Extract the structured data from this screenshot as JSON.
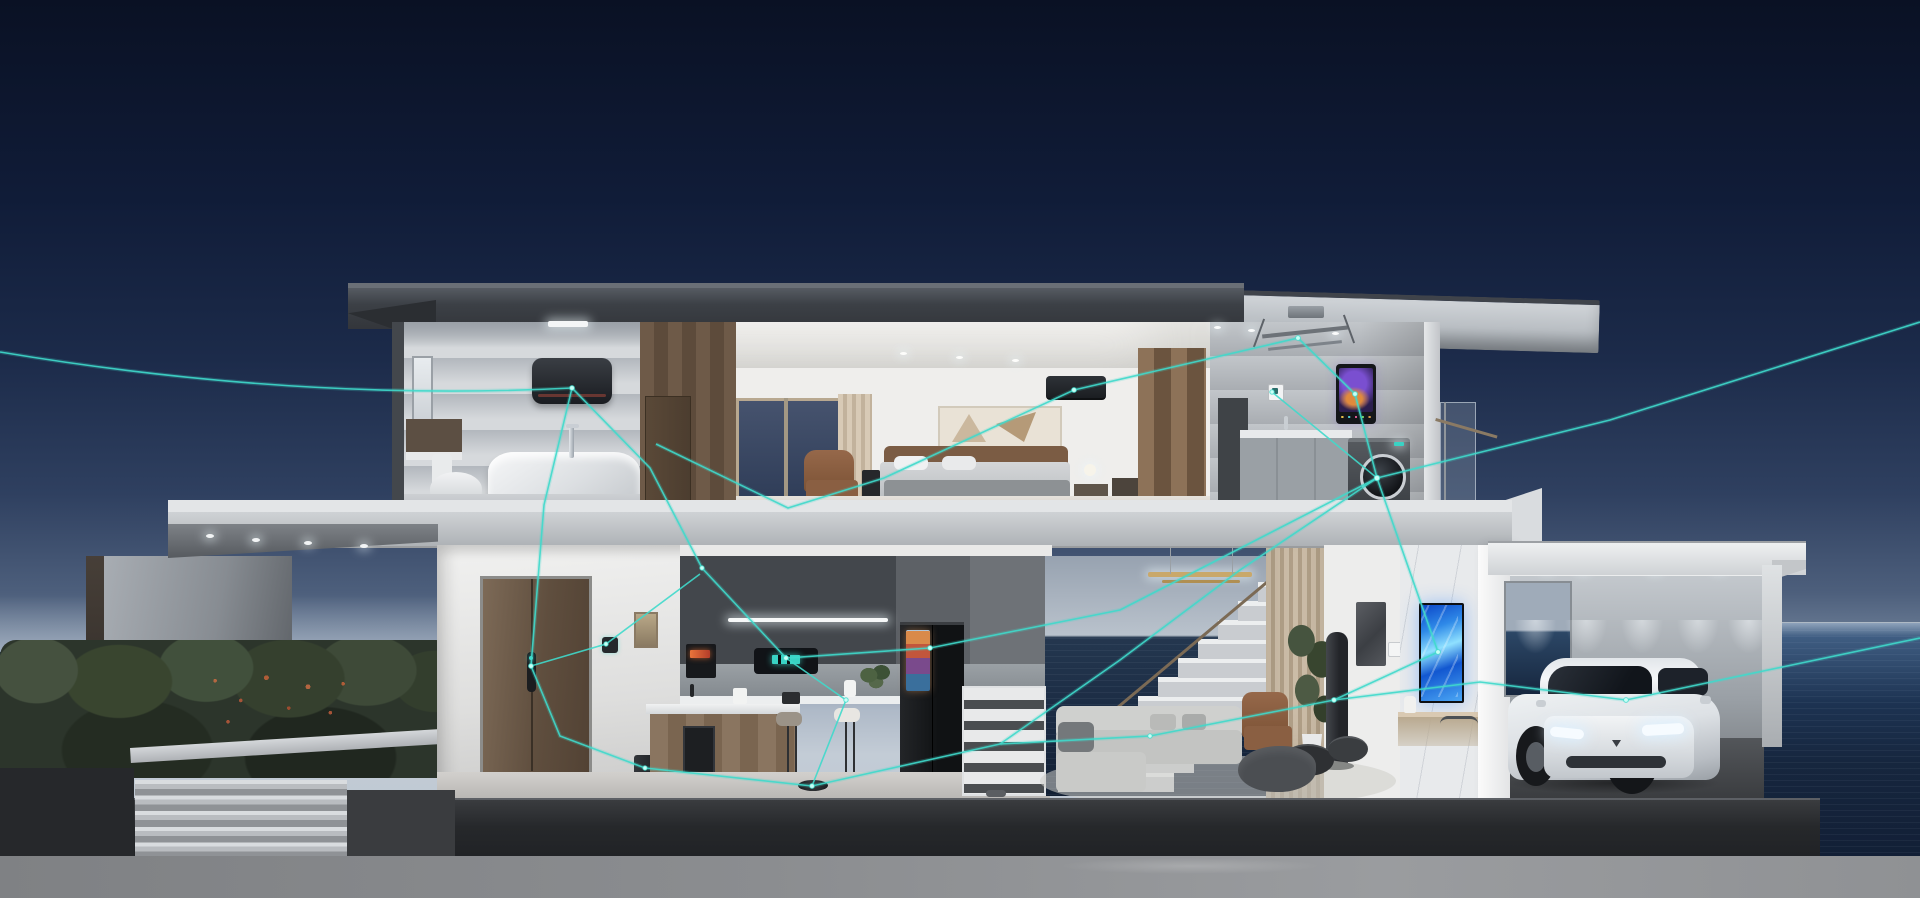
{
  "scene": {
    "title": "smart-home cutaway render",
    "description": "Dusk 3D cutaway of a two-story seaside smart home; glowing teal network lines interconnect IoT appliances in every room; a white electric SUV with lit headlights is parked in the garage",
    "time_of_day": "dusk",
    "setting": "oceanfront"
  },
  "palette": {
    "sky_top": "#0a1124",
    "sky_mid": "#2f4060",
    "horizon_haze": "#c3ccd6",
    "sea_light": "#3f5d82",
    "sea_dark": "#121f36",
    "roof_dark": "#3c4046",
    "concrete_slab": "#cfd2d5",
    "plinth": "#26282b",
    "ground": "#8b8d90",
    "hedge_green": "#323b30",
    "hedge_flower": "#b4583a",
    "door_wood": "#6a5645",
    "network_line": "#3fd9cb",
    "network_node": "#c8fff6",
    "tv_blue": "#2f8ae8",
    "car_white": "#eef1f3",
    "headlight_glow": "#f6fbff"
  },
  "exterior": {
    "ocean": "ocean with wave texture",
    "fence_wall": "concrete boundary wall",
    "hedge": "dense hedge with red-orange blossoms",
    "steps": "wide entry steps",
    "canopy_lights": "recessed canopy downlights",
    "plinth": "dark base plinth",
    "ground": "paved forecourt"
  },
  "rooms": {
    "bathroom": {
      "label": "upstairs bathroom",
      "devices": {
        "ceiling_light": "recessed ceiling light",
        "water_heater": "wall-mounted smart water heater",
        "bathtub": "freestanding bathtub",
        "faucet": "floor-standing tub faucet",
        "toilet": "toilet",
        "mirror_cabinet": "wall mirror cabinet",
        "window": "frosted window"
      }
    },
    "bedroom": {
      "label": "master bedroom",
      "devices": {
        "air_conditioner": "wall-mounted smart air conditioner",
        "artwork": "abstract framed artwork",
        "bed": "double bed",
        "armchair": "leather armchair",
        "media_panel": "bedside media panel",
        "bedside_lamp": "glowing bedside lamp",
        "window": "picture window",
        "curtain": "drape curtain",
        "wardrobe": "wood wardrobe"
      }
    },
    "laundry": {
      "label": "laundry balcony room",
      "devices": {
        "drying_rack": "ceiling-lift smart drying rack",
        "control_screen": "wall control screen with cosmic wallpaper",
        "wall_switch": "smart wall switch",
        "washer": "front-load smart washing machine",
        "cabinets": "laundry cabinets with sink",
        "railing": "glass balcony railing"
      }
    },
    "entry": {
      "label": "entry hall",
      "devices": {
        "front_door": "tall wooden front door",
        "smart_lock": "smart door lock",
        "wall_switch": "smart wall switch",
        "framed_art": "slim framed print",
        "trash_bin": "smart trash bin",
        "doormat": "door mat"
      }
    },
    "kitchen": {
      "label": "open kitchen",
      "devices": {
        "oven": "built-in oven with amber display",
        "hood_display": "built-in hood appliance with teal display",
        "cabinet_light": "under-cabinet light strip",
        "fridge": "smart refrigerator with door screen",
        "island": "kitchen island with appliances",
        "coffee_maker": "white coffee maker",
        "stools": "two bar stools",
        "robot_vacuum": "robot vacuum on floor",
        "plant": "herb plant",
        "speaker": "countertop smart speaker"
      }
    },
    "living_room": {
      "label": "double-height living room",
      "devices": {
        "staircase": "open-riser staircase with sea view",
        "cubby": "under-stair shelving",
        "pendant_light": "brass linear pendant",
        "drapes": "floor-to-ceiling drapes",
        "sofa": "gray modular sofa",
        "coffee_tables": "round nesting coffee tables",
        "armchair": "tan leather armchair",
        "bean_bag": "dark bean bag",
        "rug": "area rug",
        "plant": "tall potted plant",
        "tower_fan": "smart tower air purifier fan",
        "wall_art": "dark relief wall art",
        "thermostat": "wall thermostat",
        "tv": "portrait wall TV with blue abstract screen",
        "console": "wood console table",
        "bin": "stainless pedal bin",
        "marble_wall": "marble feature wall",
        "slippers": "slippers by the stairs"
      }
    },
    "garage": {
      "label": "open carport garage",
      "devices": {
        "spotlights": "recessed ceiling spotlights",
        "window": "rear window to the sea",
        "car": "white electric SUV with lit headlights",
        "wall_wash": "wall-washer light scallops"
      }
    }
  },
  "network": {
    "line_color": "#3fd9cb",
    "node_color": "#c8fff6",
    "node_count": 18,
    "description": "glowing teal mesh linking smart devices across the house"
  }
}
